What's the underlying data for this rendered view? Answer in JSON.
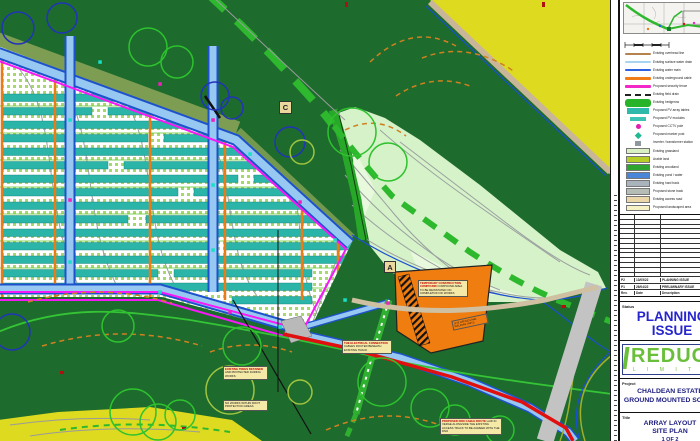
{
  "map": {
    "colors": {
      "field_dark_green": "#1d6b2d",
      "field_yellow": "#ddda1f",
      "field_pale_green": "#d6f2c8",
      "array_teal": "#2bb5a8",
      "fence_magenta": "#f718f7",
      "track_fill_blue": "#97c8f2",
      "track_edge_blue": "#1d52cc",
      "cable_red": "#e01010",
      "road_gray": "#c3c3c3",
      "path_tan": "#cfc0a2",
      "route_green_dashed": "#2eb82e",
      "compound_orange": "#f07d10",
      "cable_orange": "#e87d18"
    },
    "labels": {
      "section_c": "C",
      "section_a": "A"
    },
    "callouts": {
      "compound_main": {
        "title": "TEMPORARY CONSTRUCTION COMPOUND",
        "body": "COMPOUND AREA TO BE REINSTATED ON COMPLETION OF WORKS"
      },
      "compound_small": {
        "body": "SITE OFFICES AND WELFARE UNITS"
      },
      "electrical": {
        "title": "THE ELECTRICAL CONNECTION",
        "body": "CABLES ROUTED BENEATH EXISTING TRACK"
      },
      "trees_upper": {
        "title": "EXISTING TREES RETAINED",
        "body": "AND PROTECTED DURING WORKS"
      },
      "trees_lower": {
        "body": "NO WORKS WITHIN ROOT PROTECTION AREAS"
      },
      "dno_route": {
        "title": "PROPOSED DNO CABLE ROUTE",
        "body": "LAID IN VERGE ALONGSIDE THE EXISTING ACCESS TRACK TO BE AGREED WITH THE DNO"
      }
    }
  },
  "title_block": {
    "legend": {
      "items": [
        {
          "label": "Existing overhead line",
          "swatch": "line",
          "color": "#b5824e"
        },
        {
          "label": "Existing surface water drain",
          "swatch": "line",
          "color": "#a8d4f4"
        },
        {
          "label": "Existing water main",
          "swatch": "line",
          "color": "#2f62e0"
        },
        {
          "label": "Existing underground cable",
          "swatch": "line",
          "color": "#f07d18"
        },
        {
          "label": "Proposed security fence",
          "swatch": "line",
          "color": "#f327c8"
        },
        {
          "label": "Existing field drain",
          "swatch": "dash",
          "color": "#222222"
        },
        {
          "label": "Existing hedgerow",
          "swatch": "bigbar",
          "color": "#28b428"
        },
        {
          "label": "Proposed PV array tables",
          "swatch": "bar",
          "color": "#2eb9ab"
        },
        {
          "label": "Proposed PV modules",
          "swatch": "smallbar",
          "color": "#3ec4b4"
        },
        {
          "label": "Proposed CCTV pole",
          "swatch": "dot",
          "color": "#e020b0"
        },
        {
          "label": "Proposed marker post",
          "swatch": "diamond",
          "color": "#20b890"
        },
        {
          "label": "Inverter / transformer station",
          "swatch": "graysq",
          "color": "#8f979f"
        },
        {
          "label": "Existing grassland",
          "swatch": "rect",
          "color": "#d9f0c4"
        },
        {
          "label": "Arable land",
          "swatch": "rect",
          "color": "#b7cd28"
        },
        {
          "label": "Existing woodland",
          "swatch": "rect",
          "color": "#2ea52e"
        },
        {
          "label": "Existing pond / water",
          "swatch": "rect",
          "color": "#4a86d8"
        },
        {
          "label": "Existing hard track",
          "swatch": "rect",
          "color": "#a9b4bc"
        },
        {
          "label": "Proposed stone track",
          "swatch": "rect",
          "color": "#b6bdb4"
        },
        {
          "label": "Existing access road",
          "swatch": "rect",
          "color": "#ecd7a8"
        },
        {
          "label": "Proposed landscaped area",
          "swatch": "rect",
          "color": "#f6f2c6"
        }
      ]
    },
    "revision_table": {
      "empty_row_count": 13,
      "headers": [
        "Rev.",
        "Date",
        "Description"
      ],
      "rows": [
        {
          "rev": "P2",
          "date": "13/05/22",
          "description": "PLANNING ISSUE"
        },
        {
          "rev": "P1",
          "date": "26/04/22",
          "description": "PRELIMINARY ISSUE"
        }
      ]
    },
    "status": {
      "label": "Status",
      "value": "PLANNING ISSUE"
    },
    "logo": {
      "name": "REDUC",
      "subtitle": "L I M I T E D"
    },
    "project": {
      "label": "Project",
      "lines": [
        "CHALDEAN ESTATE",
        "GROUND MOUNTED SOLAR"
      ]
    },
    "title": {
      "label": "Title",
      "lines": [
        "ARRAY LAYOUT",
        "SITE PLAN",
        "1 OF 2"
      ]
    }
  }
}
